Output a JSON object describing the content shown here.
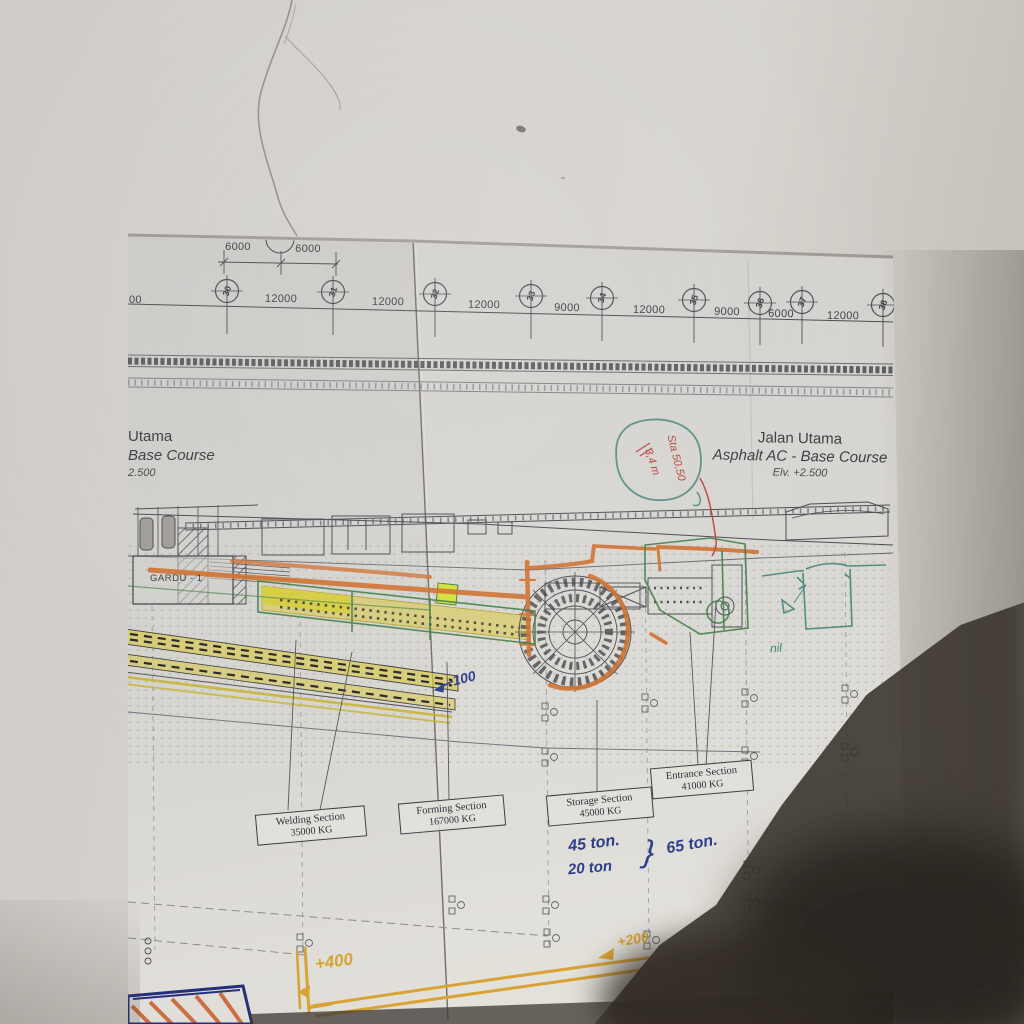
{
  "grid": {
    "bubbles": [
      "30",
      "31",
      "32",
      "33",
      "34",
      "35",
      "36",
      "37",
      "38"
    ],
    "top_dims": [
      "6000",
      "6000"
    ],
    "main_dims": [
      "12000",
      "12000",
      "12000",
      "9000",
      "12000",
      "9000",
      "6000",
      "12000"
    ],
    "left_partial_dim": "00"
  },
  "titles": {
    "left": {
      "line1": "Utama",
      "line2": "Base Course",
      "line3": "2.500"
    },
    "right": {
      "line1": "Jalan Utama",
      "line2": "Asphalt AC - Base Course",
      "line3": "Elv. +2.500"
    }
  },
  "plant": {
    "gardu_label": "GARDU - 1"
  },
  "sections": {
    "welding": {
      "name": "Welding Section",
      "weight": "35000 KG"
    },
    "forming": {
      "name": "Forming Section",
      "weight": "167000 KG"
    },
    "storage": {
      "name": "Storage Section",
      "weight": "45000 KG"
    },
    "entrance": {
      "name": "Entrance Section",
      "weight": "41000 KG"
    }
  },
  "annotations": {
    "blue": {
      "tons_top": "45 ton.",
      "tons_bottom": "20 ton",
      "brace": "}",
      "tons_total": "65 ton.",
      "rail_offset": "100"
    },
    "orange": {
      "plus400": "+400",
      "plus200": "+200"
    },
    "red": {
      "sta": "Sta 50,50",
      "dim": "3,4 m"
    },
    "teal": {
      "note": "nil"
    }
  },
  "colors": {
    "highlight_orange": "#cf6f2c",
    "highlight_yellow": "#d8c84a",
    "pen_green": "#3f7d44",
    "pen_teal": "#3f8579",
    "pen_blue": "#2c3e8c",
    "pen_red": "#b5443a",
    "pen_orange": "#d9a333"
  }
}
